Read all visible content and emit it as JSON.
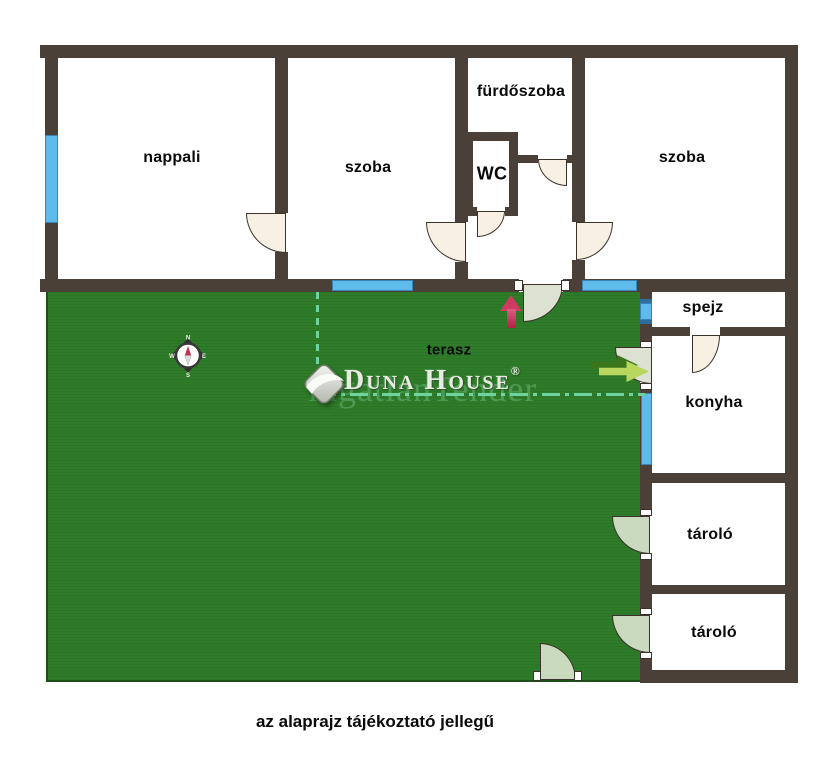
{
  "plan": {
    "rooms": {
      "nappali": "nappali",
      "szoba_left": "szoba",
      "furdoszoba": "fürdőszoba",
      "wc": "WC",
      "szoba_right": "szoba",
      "spejz": "spejz",
      "konyha": "konyha",
      "tarolo_1": "tároló",
      "tarolo_2": "tároló",
      "terasz": "terasz"
    },
    "note": "az alaprajz tájékoztató jellegű"
  },
  "compass": {
    "north": "N",
    "east": "E",
    "south": "S",
    "west": "W"
  },
  "logo": {
    "brand": "Duna House",
    "registered": "®",
    "watermark": "ingatlanTender"
  },
  "colors": {
    "wall": "#4a4038",
    "terrace_green": "#2e7b29",
    "window_blue": "#5fbbec",
    "interior_door": "#f8f1e3",
    "terrace_door": "#c9dabf",
    "entry_arrow_red": "#cf3a60",
    "garden_arrow_green": "#b9d75c",
    "guide_line_mint": "#6fd3a0"
  }
}
